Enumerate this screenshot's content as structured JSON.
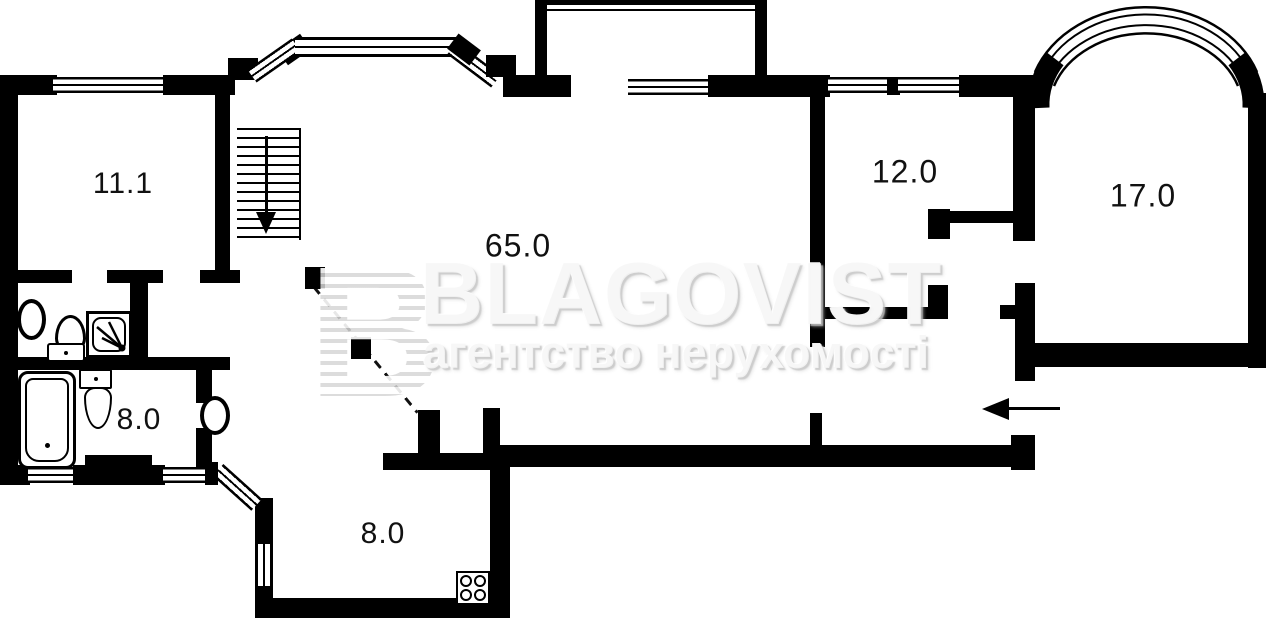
{
  "plan": {
    "title": "apartment floor plan",
    "rooms": [
      {
        "id": "room-11",
        "label": "11.1"
      },
      {
        "id": "room-65",
        "label": "65.0"
      },
      {
        "id": "room-12",
        "label": "12.0"
      },
      {
        "id": "room-17",
        "label": "17.0"
      },
      {
        "id": "room-8-bath",
        "label": "8.0"
      },
      {
        "id": "room-8-kitchen",
        "label": "8.0"
      }
    ],
    "fixtures": [
      "staircase-down-arrow",
      "bathtub",
      "toilet",
      "pedestal-sink",
      "shower-cabin",
      "stove-4-burners",
      "balcony",
      "arched-bay-window",
      "entrance-arrow",
      "door-ovals",
      "dashed-sight-line"
    ],
    "colors": {
      "wall": "#000000",
      "background": "#ffffff",
      "label_text": "#111111",
      "watermark": "#f0f0f0"
    }
  },
  "watermark": {
    "logo_letter": "B",
    "brand": "BLAGOVIST",
    "tagline": "агентство нерухомості"
  }
}
